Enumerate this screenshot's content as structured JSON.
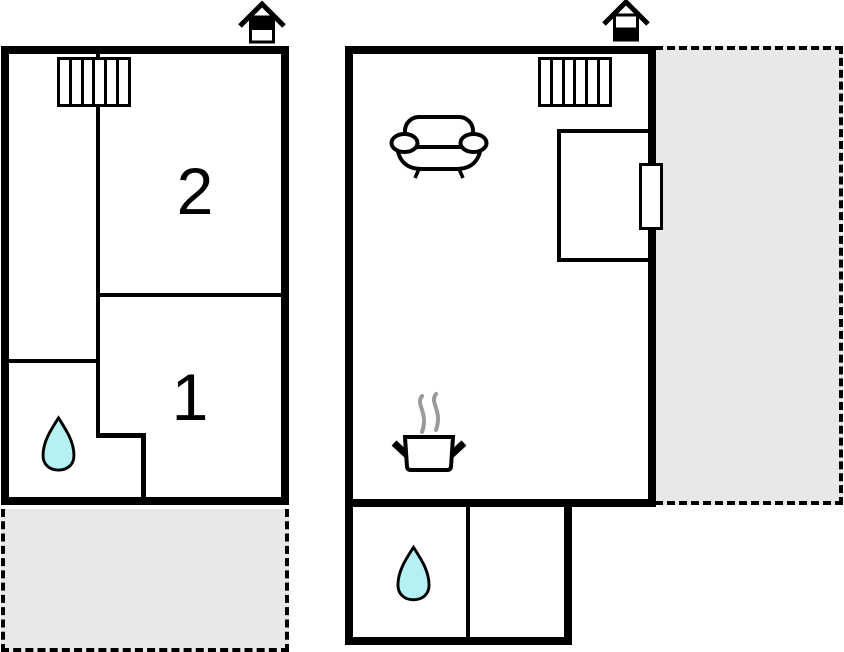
{
  "colors": {
    "wall": "#000000",
    "terrace_fill": "#e8e8e8",
    "water_fill": "#b5f1f2",
    "steam": "#9a9a9a",
    "window_fill": "#ffffff"
  },
  "upper_plan": {
    "rooms": [
      {
        "label": "2"
      },
      {
        "label": "1"
      }
    ],
    "icons": {
      "chimney": "chimney-icon",
      "stairs": "staircase-icon",
      "water": "water-drop-icon"
    },
    "terrace_position": "bottom"
  },
  "ground_plan": {
    "rooms": [],
    "icons": {
      "chimney": "chimney-icon",
      "stairs": "staircase-icon",
      "sofa": "sofa-icon",
      "stove": "cooking-pot-icon",
      "window": "window-icon",
      "water": "water-drop-icon"
    },
    "terrace_position": "right"
  }
}
